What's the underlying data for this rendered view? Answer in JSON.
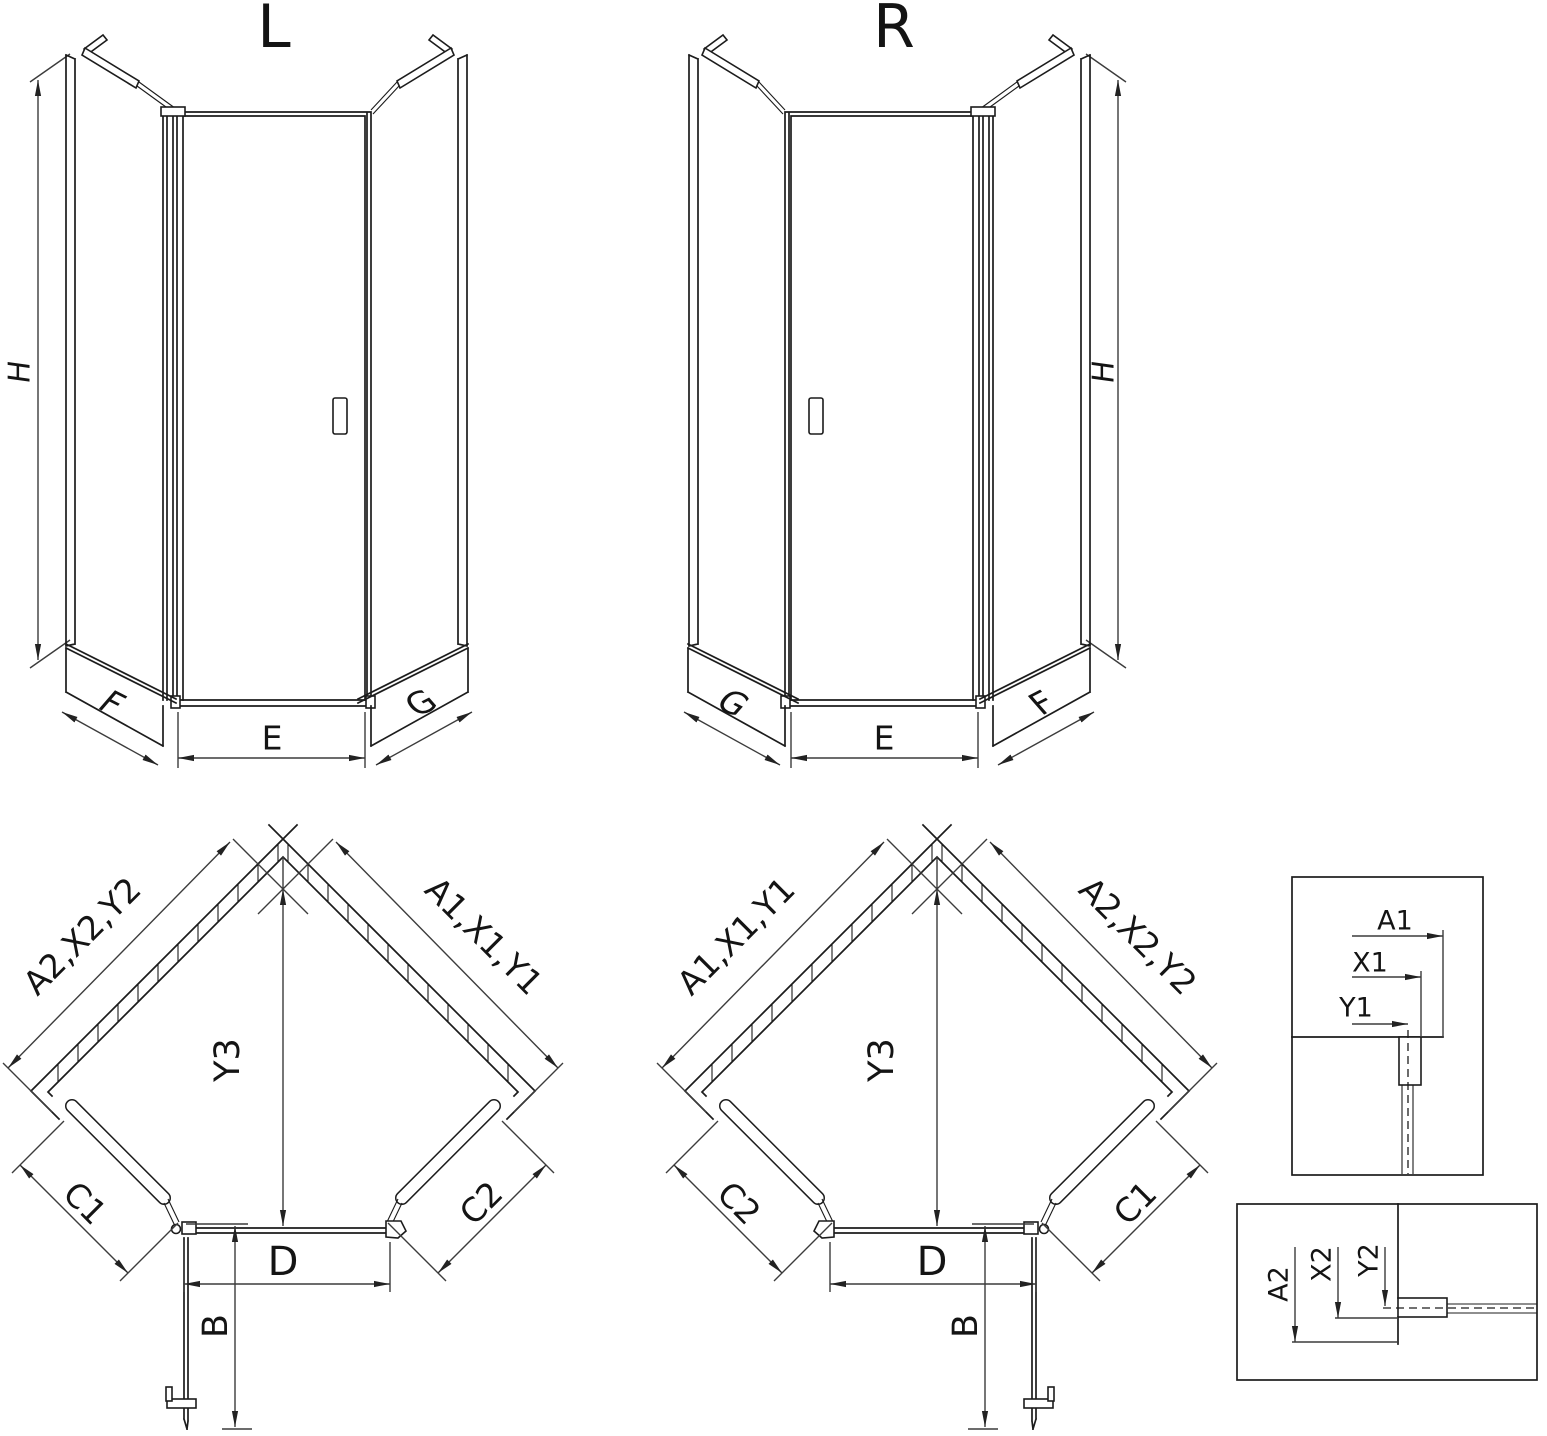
{
  "colors": {
    "line": "#1c1c1c",
    "dimension": "#3c3c3c",
    "background": "#ffffff"
  },
  "front_left": {
    "title": "L",
    "dim_height": "H",
    "dim_tray_left": "F",
    "dim_door": "E",
    "dim_tray_right": "G"
  },
  "front_right": {
    "title": "R",
    "dim_height": "H",
    "dim_tray_left": "G",
    "dim_door": "E",
    "dim_tray_right": "F"
  },
  "plan_left": {
    "dim_wall_left": "A2,X2,Y2",
    "dim_wall_right": "A1,X1,Y1",
    "dim_depth": "Y3",
    "dim_panel_left": "C1",
    "dim_panel_right": "C2",
    "dim_door": "D",
    "dim_swing": "B"
  },
  "plan_right": {
    "dim_wall_left": "A1,X1,Y1",
    "dim_wall_right": "A2,X2,Y2",
    "dim_depth": "Y3",
    "dim_panel_left": "C2",
    "dim_panel_right": "C1",
    "dim_door": "D",
    "dim_swing": "B"
  },
  "detail_top": {
    "dim_a": "A1",
    "dim_x": "X1",
    "dim_y": "Y1"
  },
  "detail_bottom": {
    "dim_a": "A2",
    "dim_x": "X2",
    "dim_y": "Y2"
  }
}
